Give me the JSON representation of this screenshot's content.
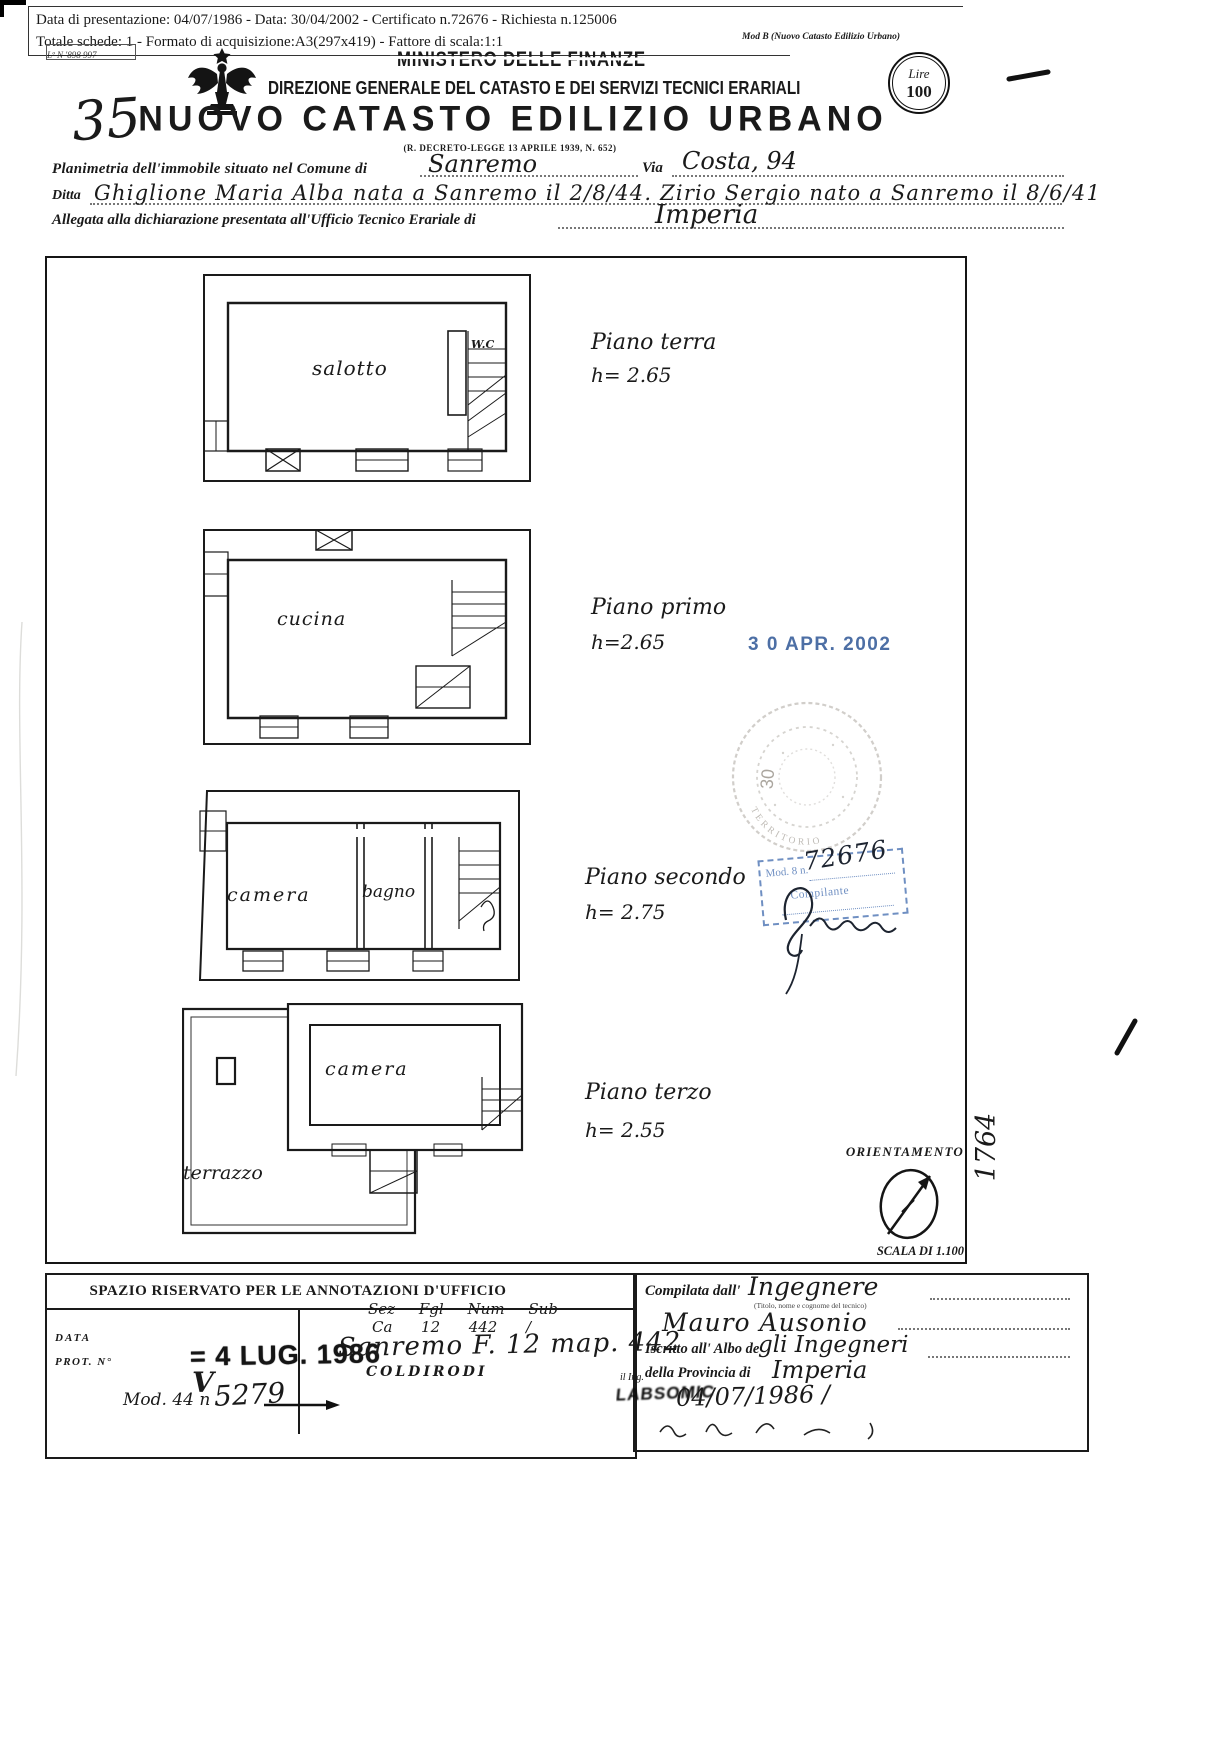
{
  "page": {
    "bg": "#ffffff",
    "ink": "#1a1a1a",
    "stamp_blue": "#3e639e",
    "stamp_blue_light": "#6f8fc2",
    "faint_stamp_gray": "#958f86"
  },
  "meta": {
    "line1": "Data di presentazione: 04/07/1986   -   Data: 30/04/2002   -   Certificato n.72676   -   Richiesta n.125006",
    "line2": "Totale schede: 1   -   Formato di acquisizione:A3(297x419) - Fattore di scala:1:1",
    "mod_label": "Mod B (Nuovo Catasto Edilizio Urbano)",
    "corner_note": "Lº N '898 997"
  },
  "header": {
    "ministero": "MINISTERO DELLE FINANZE",
    "direzione": "DIREZIONE GENERALE DEL CATASTO E DEI SERVIZI TECNICI ERARIALI",
    "titolo": "NUOVO CATASTO EDILIZIO URBANO",
    "decreto": "(R. DECRETO-LEGGE 13 APRILE 1939, N. 652)",
    "numero_scheda": "35",
    "lire_line1": "Lire",
    "lire_line2": "100"
  },
  "form": {
    "planimetria_label": "Planimetria dell'immobile situato nel Comune di",
    "comune": "Sanremo",
    "via_label": "Via",
    "via": "Costa, 94",
    "ditta_label": "Ditta",
    "ditta": "Ghiglione Maria Alba nata a Sanremo il 2/8/44. Zirio Sergio nato a Sanremo il 8/6/41",
    "allegata_label": "Allegata alla dichiarazione presentata all'Ufficio Tecnico Erariale di",
    "ufficio": "Imperia"
  },
  "floors": [
    {
      "label": "Piano terra",
      "height": "h= 2.65",
      "room1": "salotto",
      "room2": "W.C"
    },
    {
      "label": "Piano primo",
      "height": "h=2.65",
      "room1": "cucina"
    },
    {
      "label": "Piano secondo",
      "height": "h= 2.75",
      "room1": "camera",
      "room2": "bagno"
    },
    {
      "label": "Piano terzo",
      "height": "h= 2.55",
      "room1": "camera",
      "room2": "terrazzo"
    }
  ],
  "stamps": {
    "date_received": "3 0 APR. 2002",
    "round_number": "30",
    "round_arc": "TERRITORIO",
    "mod8_label": "Mod. 8 n.",
    "mod8_number": "72676",
    "mod8_role": "Compilante",
    "protocol_stamp": "= 4 LUG. 1986",
    "illegible_stamp": "LABSOMIC"
  },
  "orientamento": {
    "label": "ORIENTAMENTO",
    "scala": "SCALA DI 1.100"
  },
  "margin": {
    "vertical_number": "1764"
  },
  "annotazioni": {
    "titolo": "SPAZIO RISERVATO PER LE ANNOTAZIONI D'UFFICIO",
    "col_headers": "Sez     Fgl     Num     Sub",
    "col_values": "Ca      12      442      /",
    "data_label": "DATA",
    "prot_label": "PROT. N°",
    "mod44_label": "Mod. 44 n",
    "mod44_check": "V",
    "mod44_number": "5279",
    "mappale": "Sanremo F. 12 map. 442",
    "frazione": "COLDIRODI"
  },
  "compilazione": {
    "compilata_label": "Compilata dall'",
    "compilata": "Ingegnere",
    "tecnico_note": "(Titolo, nome e cognome del tecnico)",
    "nome": "Mauro Ausonio",
    "iscritto_label": "Iscritto all' Albo de",
    "iscritto": "gli  Ingegneri",
    "provincia_label": "della Provincia di",
    "provincia": "Imperia",
    "ing_label": "il Ing.",
    "data_firma": "04/07/1986  /"
  }
}
